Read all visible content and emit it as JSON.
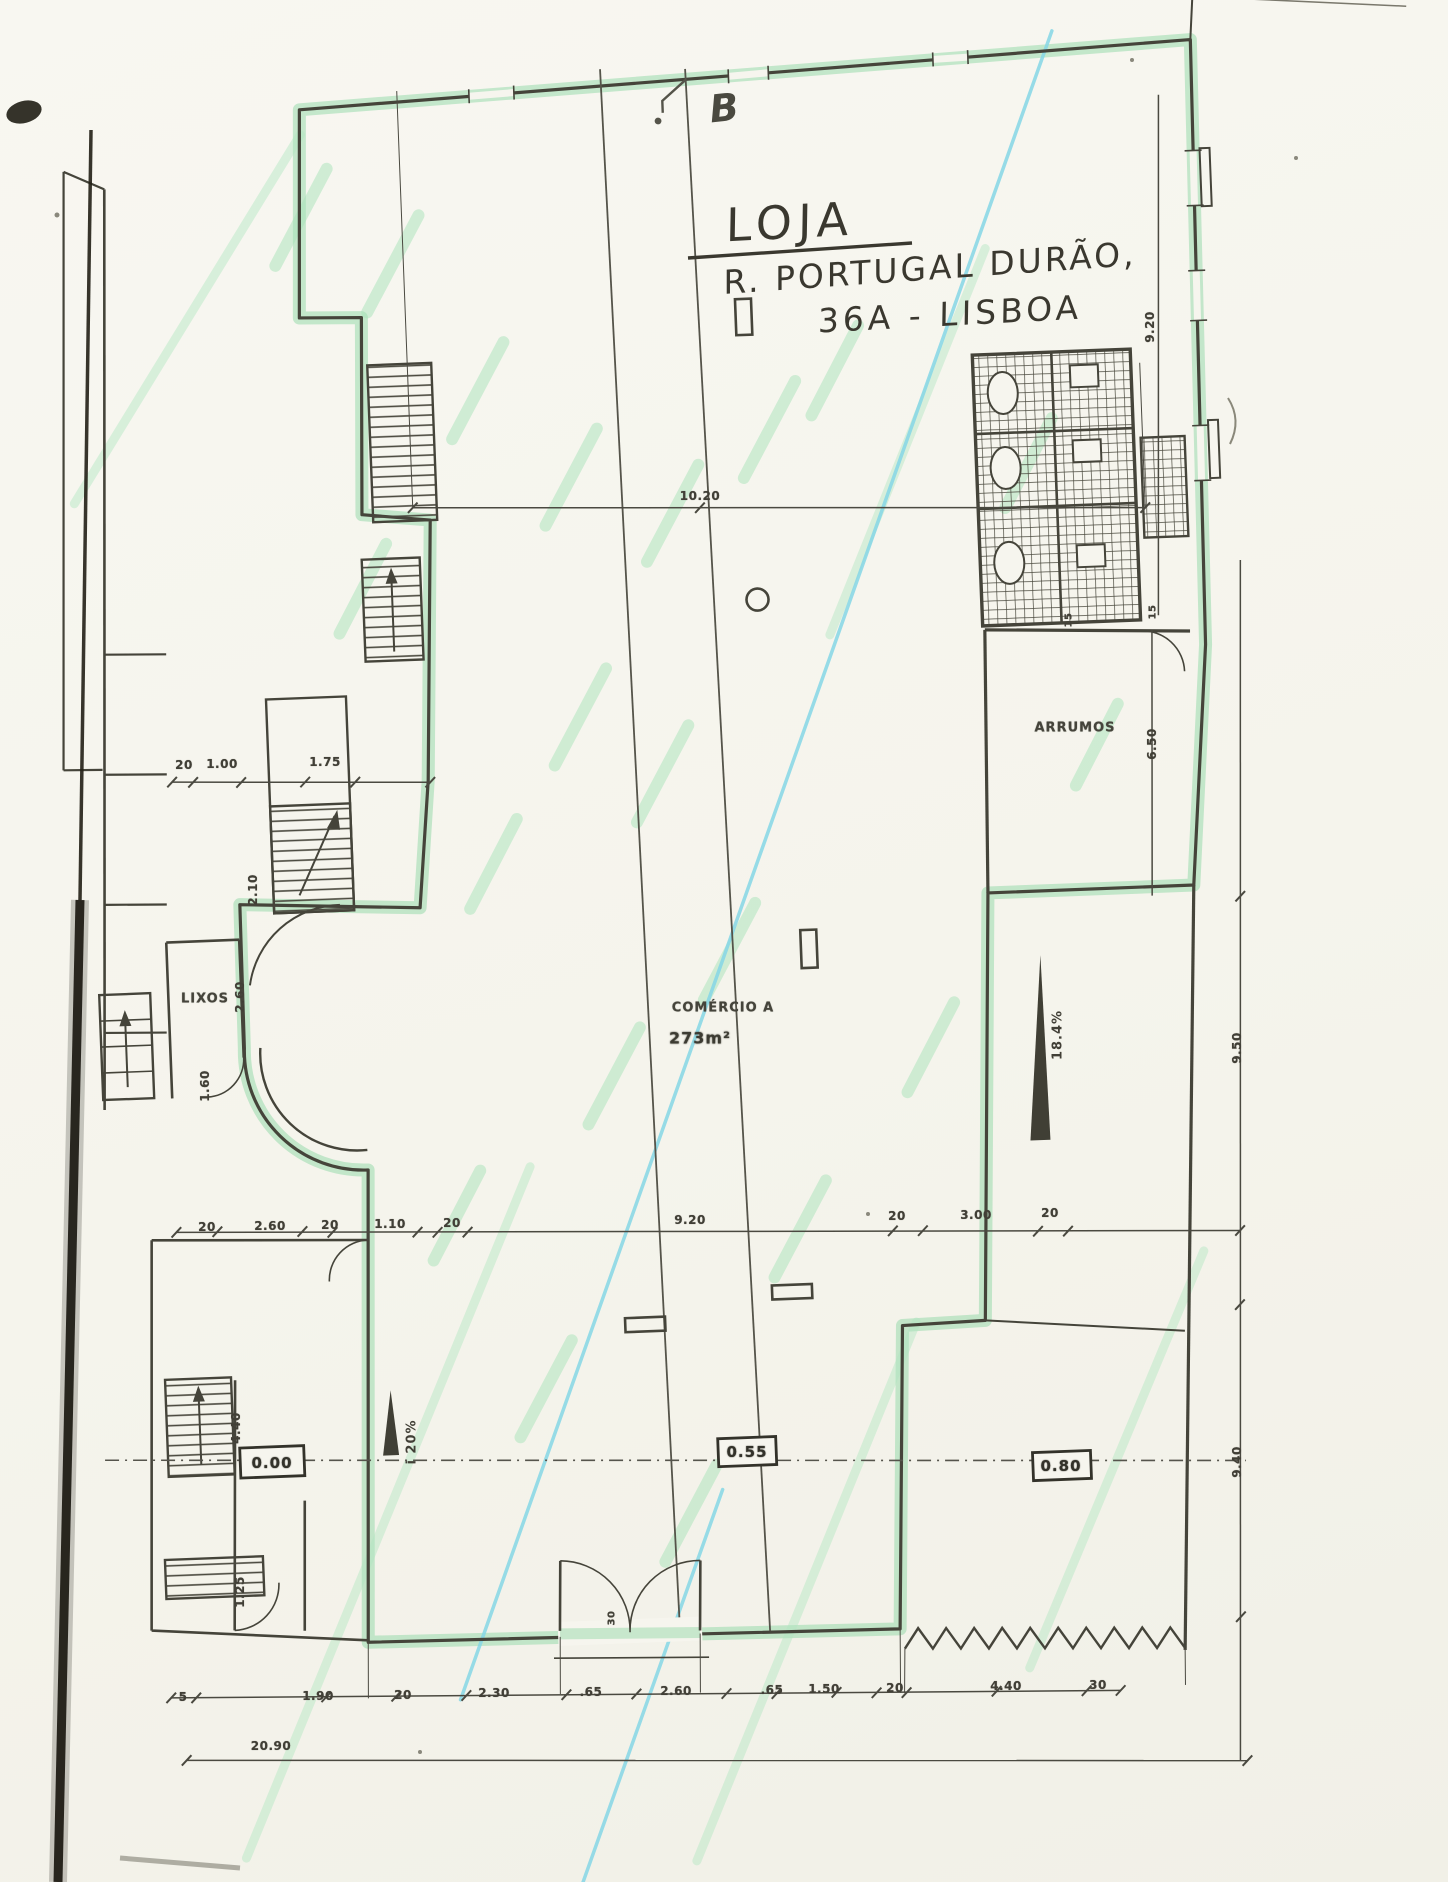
{
  "handwriting": {
    "title": "LOJA",
    "address1": "R. PORTUGAL DURÃO,",
    "address2": "36A - LISBOA",
    "section": "B"
  },
  "rooms": {
    "arrumos": "ARRUMOS",
    "lixos": "LIXOS",
    "comercio_name": "COMÉRCIO A",
    "comercio_area": "273m²"
  },
  "levels": [
    "0.00",
    "0.55",
    "0.80"
  ],
  "slopes": [
    "i 20%",
    "18.4%"
  ],
  "dims": {
    "top": "10.20",
    "upper_left": [
      "20",
      "1.00",
      "1.75"
    ],
    "middle": [
      "20",
      "2.60",
      "20",
      "1.10",
      "20",
      "9.20",
      "20",
      "3.00",
      "20"
    ],
    "bottom": [
      "5",
      "1.90",
      "20",
      "2.30",
      ".65",
      "2.60",
      ".65",
      "1.50",
      "20",
      "4.40",
      "30"
    ],
    "total": "20.90",
    "right_vertical": [
      "9.20",
      "6.50",
      "9.50",
      "9.40"
    ],
    "left_vertical": [
      "2.10",
      "2.60",
      "1.60",
      "4.40",
      "1.25"
    ],
    "wall_thickness": [
      "15",
      "15"
    ],
    "door": "30"
  },
  "colors": {
    "ink": "#45443a",
    "highlight_green": "#8fd8a5",
    "highlight_cyan": "#86d7e6",
    "paper": "#f6f5ee"
  }
}
